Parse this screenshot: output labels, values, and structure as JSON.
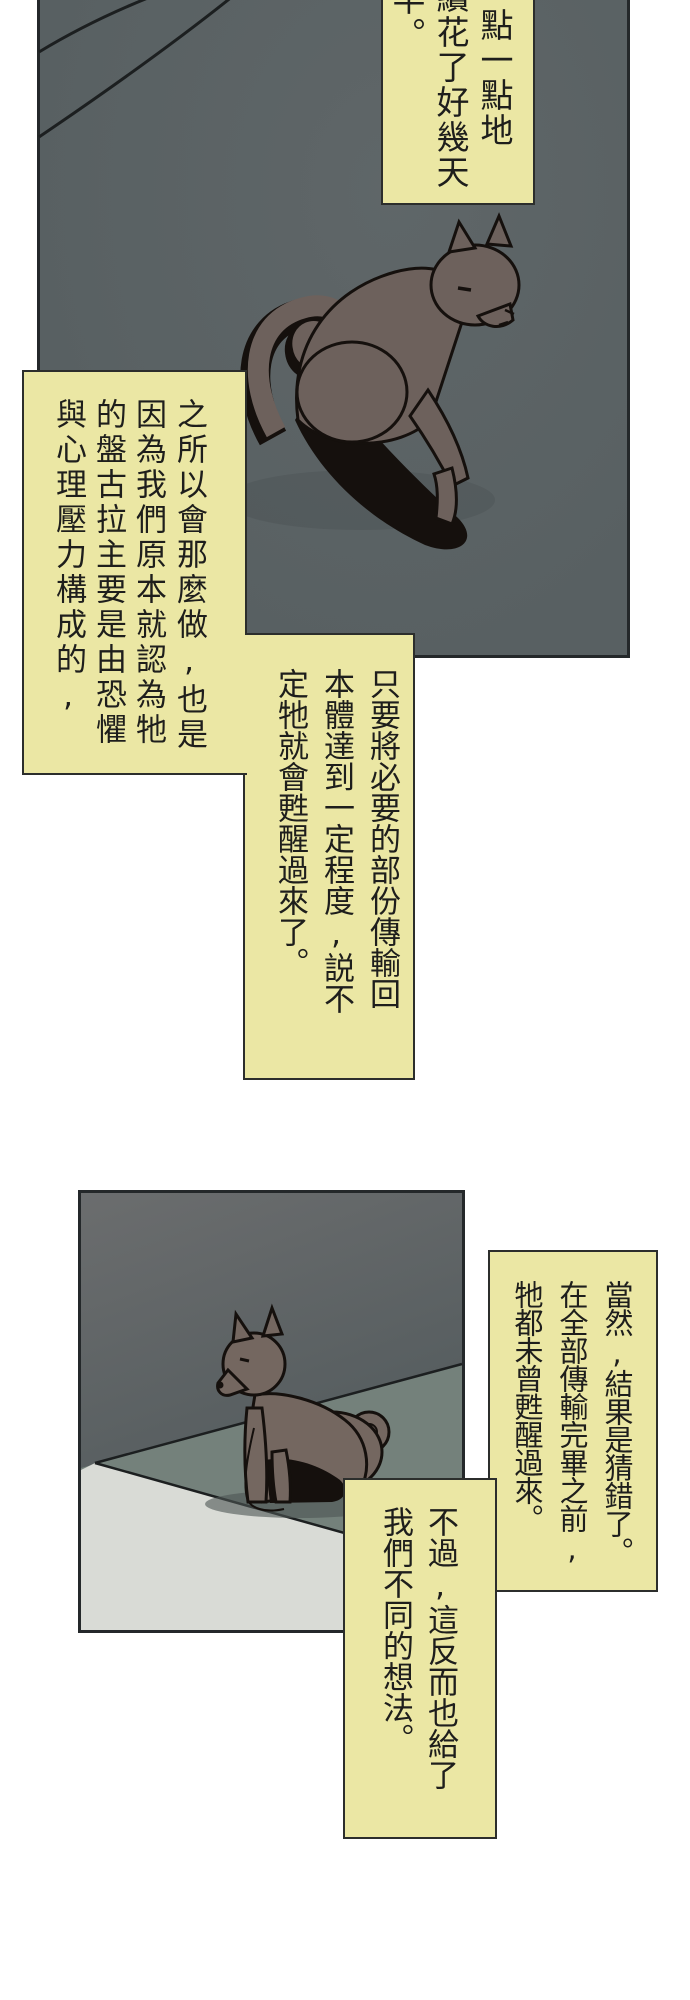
{
  "page": {
    "kind": "comic-page",
    "background": "#ffffff",
    "balloon_fill": "#ebe7a4",
    "balloon_border": "#2c2e2c",
    "panel_border": "#24282a"
  },
  "panels": [
    {
      "name": "panel-1",
      "artwork": "dog-lying-on-floor",
      "wall_color": "#5c6365",
      "dog_color": "#6d615c",
      "outline_color": "#15100d"
    },
    {
      "name": "panel-2",
      "artwork": "dog-sitting-on-floor",
      "wall_color": "#5a6163",
      "floor_color": "#74817b",
      "floor_front_color": "#d9dbd6",
      "dog_color": "#746760",
      "outline_color": "#15100d"
    }
  ],
  "balloons": {
    "top": {
      "full_text": "點一點地 續花了好幾天 半。",
      "columns": [
        "點一點地",
        "續花了好幾天",
        "半。"
      ]
    },
    "reason": {
      "full_text": "之所以會那麼做,也是因為我們原本就認為牠的盤古拉主要是由恐懼與心理壓力構成的,",
      "columns": [
        "之所以會那麼做,也是",
        "因為我們原本就認為牠",
        "的盤古拉主要是由恐懼",
        "與心理壓力構成的,"
      ]
    },
    "transfer": {
      "full_text": "只要將必要的部份傳輸回本體達到一定程度,説不定牠就會甦醒過來了。",
      "columns": [
        "只要將必要的部份傳輸回",
        "本體達到一定程度,説不",
        "定牠就會甦醒過來了。"
      ]
    },
    "result": {
      "full_text": "當然,結果是猜錯了。在全部傳輸完畢之前,牠都未曾甦醒過來。",
      "columns": [
        "當然,結果是猜錯了。",
        "在全部傳輸完畢之前,",
        "牠都未曾甦醒過來。"
      ]
    },
    "idea": {
      "full_text": "不過,這反而也給了我們不同的想法。",
      "columns": [
        "不過,這反而也給了",
        "我們不同的想法。"
      ]
    }
  }
}
